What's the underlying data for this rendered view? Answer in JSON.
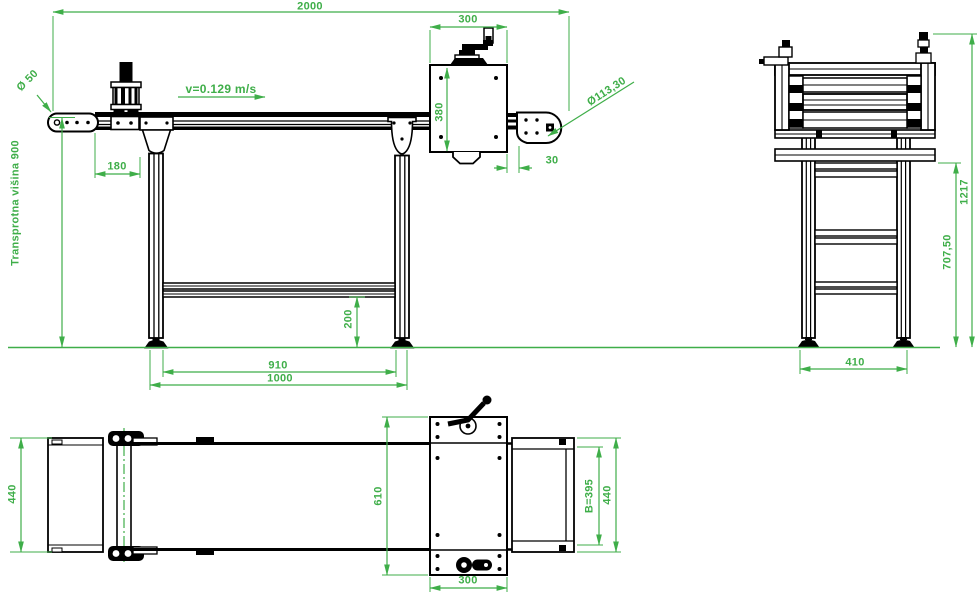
{
  "colors": {
    "dimension_green": "#3fae49",
    "geometry_black": "#000000",
    "background": "#ffffff"
  },
  "labels": {
    "dim_overall_length": "2000",
    "dim_drive_width_top": "300",
    "belt_speed": "v=0.129 m/s",
    "dia_tail_pulley": "Ø 50",
    "dim_tail_offset": "180",
    "dim_drive_height": "380",
    "dim_drive_offset": "30",
    "dia_drive_pulley": "Ø113,30",
    "transport_height_note": "Transprotna višina 900",
    "dim_brace_height": "200",
    "dim_leg_span_inner": "910",
    "dim_leg_span_outer": "1000",
    "dim_total_height": "1217",
    "dim_frame_height": "707,50",
    "dim_foot_span": "410",
    "dim_left_assembly_width": "440",
    "dim_drive_depth": "610",
    "dim_belt_width": "B=395",
    "dim_overall_width": "440",
    "dim_drive_width_bottom": "300"
  }
}
